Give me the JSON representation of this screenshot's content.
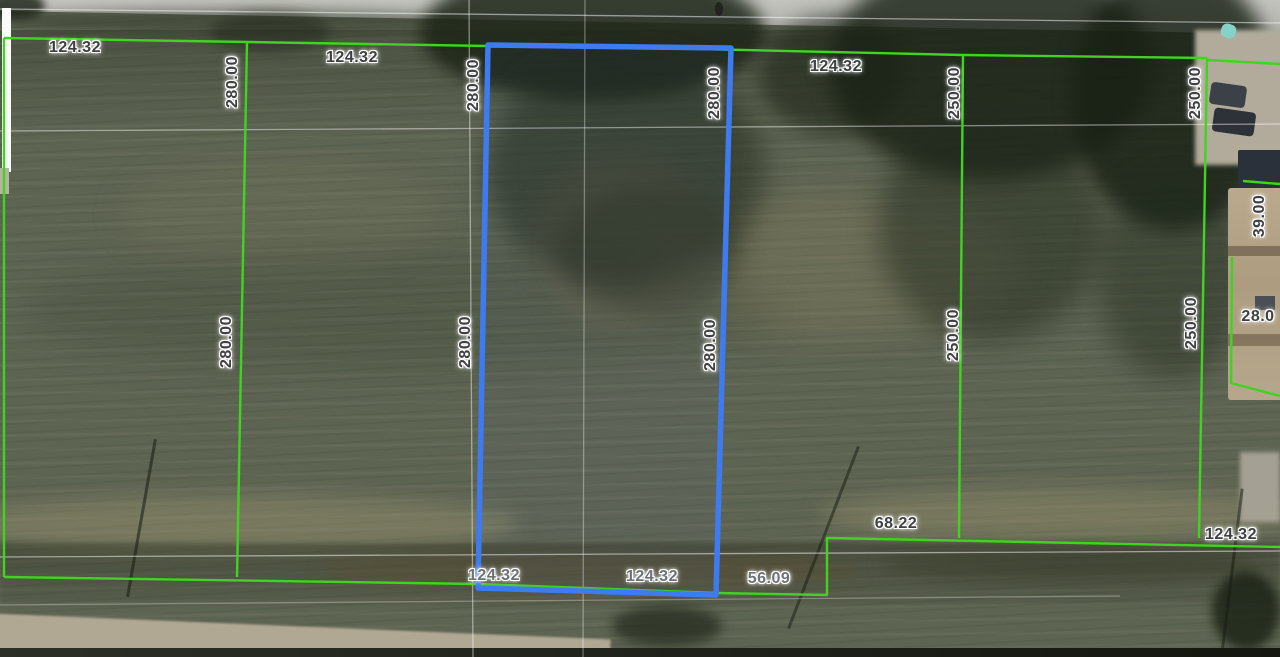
{
  "map": {
    "view_type": "aerial-parcel-map",
    "boundary_color": "#3fd41f",
    "survey_line_color": "#ffffff",
    "highlighted_parcel": {
      "outline_color": "#3e7bf0",
      "frontage": "124.32",
      "depth": "280.00"
    },
    "labels": [
      {
        "text": "124.32"
      },
      {
        "text": "124.32"
      },
      {
        "text": "124.32"
      },
      {
        "text": "280.00"
      },
      {
        "text": "280.00"
      },
      {
        "text": "280.00"
      },
      {
        "text": "250.00"
      },
      {
        "text": "250.00"
      },
      {
        "text": "39.00"
      },
      {
        "text": "280.00"
      },
      {
        "text": "280.00"
      },
      {
        "text": "280.00"
      },
      {
        "text": "250.00"
      },
      {
        "text": "250.00"
      },
      {
        "text": "28.0"
      },
      {
        "text": "68.22"
      },
      {
        "text": "124.32"
      },
      {
        "text": "124.32"
      },
      {
        "text": "124.32"
      },
      {
        "text": "56.09"
      }
    ]
  }
}
